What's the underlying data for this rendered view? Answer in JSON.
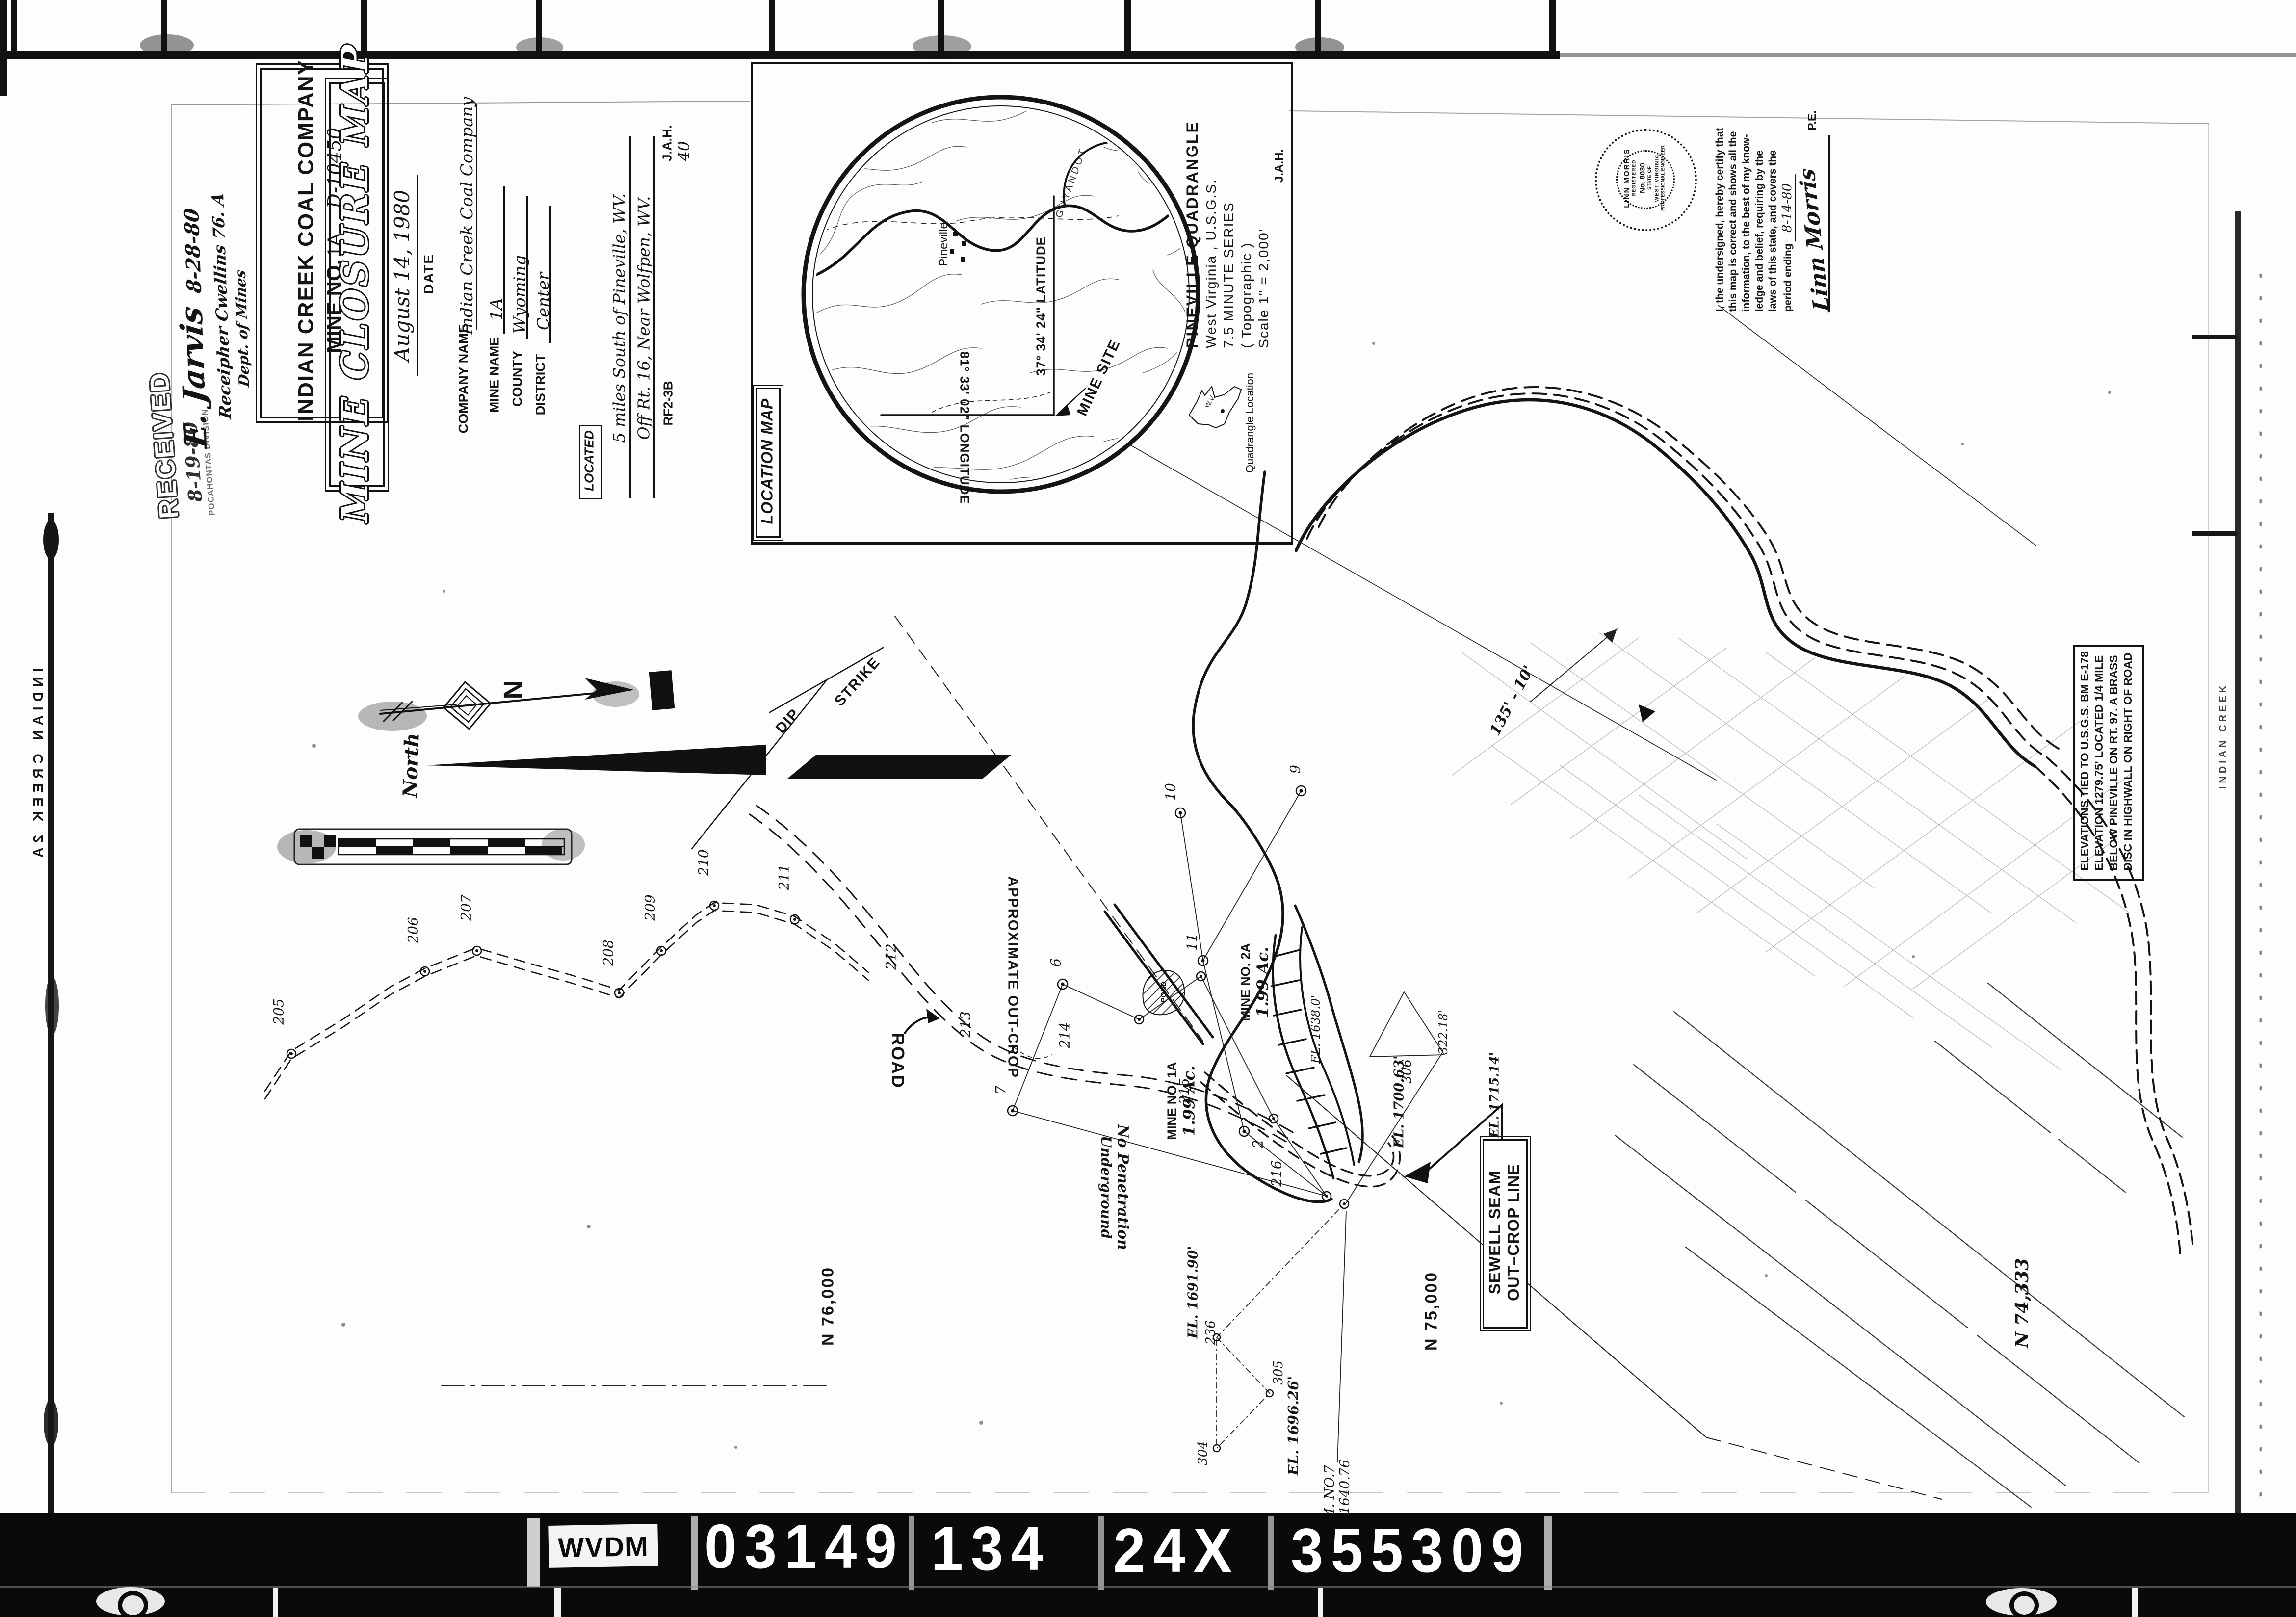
{
  "film": {
    "edge_left": "INDIAN CREEK  2A",
    "edge_right": "INDIAN CREEK",
    "strip": {
      "box_label": "WVDM",
      "numbers": [
        "03149",
        "134",
        "24X",
        "355309"
      ]
    }
  },
  "header": {
    "company": "INDIAN CREEK COAL COMPANY",
    "mine_no_label": "MINE NO.",
    "mine_no": "1A",
    "drawing_no": "D-10450"
  },
  "received": {
    "stamp": "RECEIVED",
    "date": "8-19-80",
    "division": "POCAHONTAS DIVISION"
  },
  "signatures": {
    "sig1": "E. Jarvis",
    "sig1_date": "8-28-80",
    "sig2": "Receipher Cwellins 76. A",
    "sig3": "Dept. of Mines"
  },
  "title_block": {
    "title": "MINE CLOSURE MAP",
    "date_value": "August 14, 1980",
    "date_label": "DATE",
    "fields": [
      {
        "label": "COMPANY NAME",
        "value": "Indian Creek Coal Company"
      },
      {
        "label": "MINE NAME",
        "value": "1A"
      },
      {
        "label": "COUNTY",
        "value": "Wyoming"
      },
      {
        "label": "DISTRICT",
        "value": "Center"
      }
    ],
    "located_label": "LOCATED",
    "located_line1": "5 miles South of Pineville, WV.",
    "located_line2": "Off Rt. 16, Near Wolfpen, WV.",
    "form_no": "RF2-3B",
    "initials": "J.A.H.",
    "sheet_no": "40"
  },
  "location_map": {
    "label": "LOCATION MAP",
    "quad_line1": "PINEVILLE QUADRANGLE",
    "quad_line2": "West Virginia , U.S.G.S.",
    "quad_line3": "7.5 MINUTE SERIES",
    "quad_line4": "( Topographic )",
    "quad_line5": "Scale 1\" = 2,000'",
    "initials": "J.A.H.",
    "latitude": "37° 34' 24\" LATITUDE",
    "longitude": "81° 33' 02\" LONGITUDE",
    "mine_site": "MINE SITE",
    "town": "Pineville",
    "river": "GUYANDOT",
    "quad_location": "Quadrangle Location",
    "wv": "W.V."
  },
  "certification": {
    "line1": "I, the undersigned, hereby certify that",
    "line2": "this map is correct and shows all the",
    "line3": "information, to the best of my know-",
    "line4": "ledge and belief, requiring by the",
    "line5": "laws of this state, and covers the",
    "line6": "period ending",
    "period_date": "8-14-80",
    "signature": "Linn Morris",
    "pe": "P.E."
  },
  "seal": {
    "name": "LINN MORRIS",
    "l2": "REGISTERED",
    "l3": "No. 8030",
    "l4": "STATE OF",
    "l5": "WEST VIRGINIA",
    "l6": "PROFESSIONAL ENGINEER"
  },
  "elevation_note": {
    "line1": "ELEVATIONS TIED TO  U.S.G.S.  BM  E-178",
    "line2": "ELEVATION  1279.75'   LOCATED  1/4  MILE",
    "line3": "BELOW  PINEVILLE  ON  RT.  97.   A  BRASS",
    "line4": "DISC  IN  HIGHWALL  ON  RIGHT  OF  ROAD"
  },
  "map": {
    "north": "North",
    "n": "N",
    "strike": "STRIKE",
    "dip": "DIP",
    "road": "ROAD",
    "approx_outcrop": "APPROXIMATE  OUT-CROP",
    "no_penetration1": "No Penetration",
    "no_penetration2": "Underground",
    "sewell1": "SEWELL SEAM",
    "sewell2": "OUT–CROP LINE",
    "n76": "N 76,000",
    "n75": "N 75,000",
    "n74": "N 74,333",
    "mine2a_1": "MINE NO. 2A",
    "mine2a_2": "1.99 Ac.",
    "mine1a_1": "MINE NO. 1A",
    "mine1a_2": "1.99 Ac.",
    "pond": "POND",
    "bm7_1": "B.M. NO.7",
    "bm7_2": "EL. 1640.76",
    "el1638": "EL. 1638.0'",
    "el170063": "EL. 1700.63'",
    "el171514": "EL. 1715.14'",
    "el169190": "EL. 1691.90'",
    "el169626": "EL. 1696.26'",
    "d32218": "322.18'",
    "hand135": "135' - 10'",
    "stations": [
      "205",
      "206",
      "207",
      "208",
      "209",
      "210",
      "211",
      "212",
      "213",
      "214",
      "215",
      "216",
      "236",
      "304",
      "305",
      "306",
      "2",
      "6",
      "7",
      "9",
      "10",
      "11"
    ]
  }
}
